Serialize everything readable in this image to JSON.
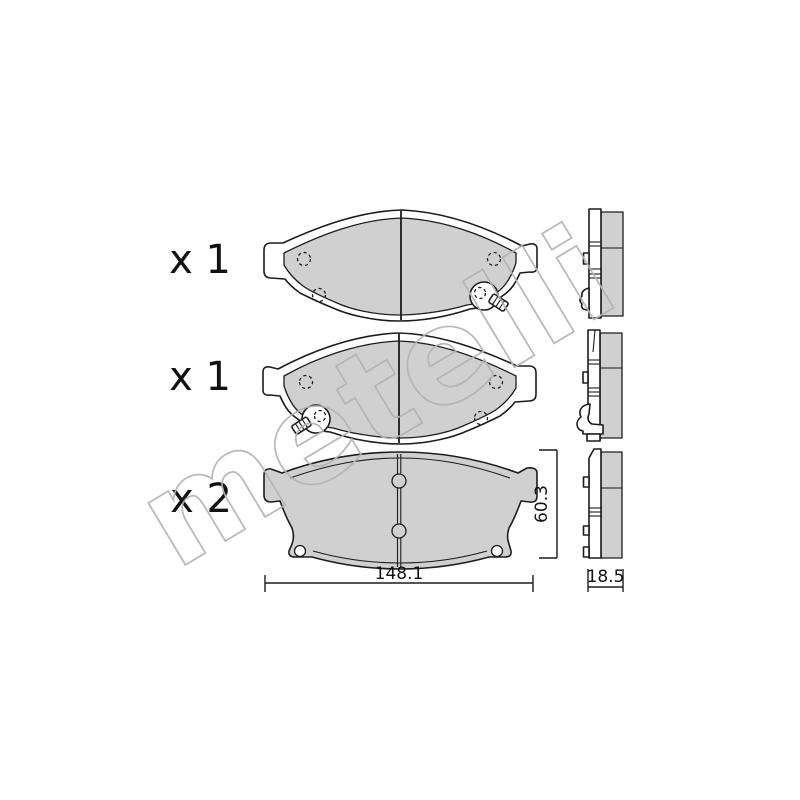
{
  "drawing": {
    "watermark": "metelli",
    "items": [
      {
        "view": "front-pad-with-wear-indicator-right",
        "label": "x 1"
      },
      {
        "view": "front-pad-with-wear-indicator-left",
        "label": "x 1"
      },
      {
        "view": "back-plate",
        "label": "x 2"
      }
    ],
    "dimensions": {
      "width_mm": "148.1",
      "height_mm": "60.3",
      "thickness_mm": "18.5"
    },
    "colors": {
      "background": "#ffffff",
      "outline": "#1c1c1c",
      "pad_fill": "#d0d0d0",
      "watermark": "#b3b3b3"
    }
  }
}
